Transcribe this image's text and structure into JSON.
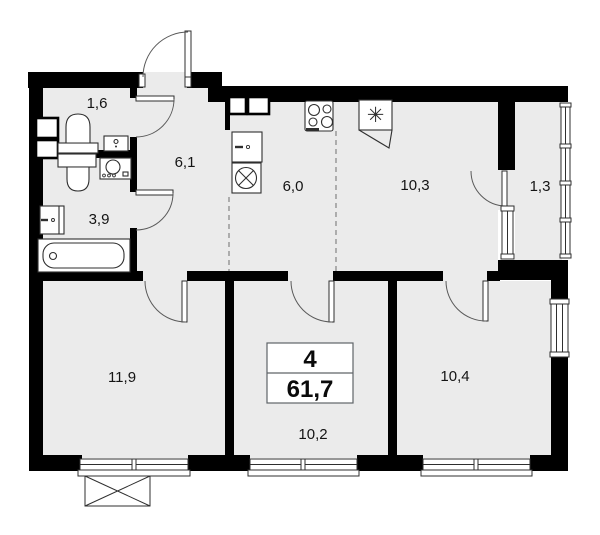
{
  "floorplan": {
    "summary": {
      "rooms_count": "4",
      "total_area": "61,7"
    },
    "rooms": {
      "wc": {
        "area": "1,6"
      },
      "hallway": {
        "area": "6,1"
      },
      "bathroom": {
        "area": "3,9"
      },
      "kitchen": {
        "area": "6,0"
      },
      "room_top": {
        "area": "10,3"
      },
      "loggia": {
        "area": "1,3"
      },
      "room_left": {
        "area": "11,9"
      },
      "room_center": {
        "area": "10,2"
      },
      "room_right": {
        "area": "10,4"
      }
    },
    "symbols": {
      "fridge": "✳"
    },
    "colors": {
      "wall": "#000000",
      "floor": "#ebebeb",
      "background": "#ffffff",
      "outline": "#2f2f2f"
    }
  }
}
